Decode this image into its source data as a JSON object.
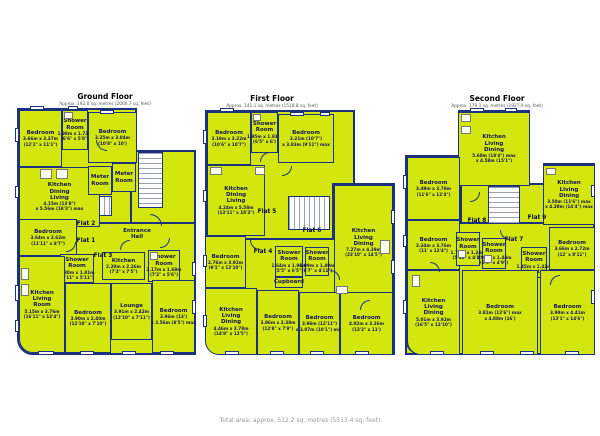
{
  "colors": {
    "room_fill": "#d3e70e",
    "wall": "#1d3181",
    "label_text": "#15135a",
    "title_text": "#000000",
    "subtitle_text": "#555555",
    "footer_text": "#9a9a9a"
  },
  "footer": {
    "total_area": "Total area: approx. 512.2 sq. metres (5513.4 sq. feet)"
  },
  "floors": [
    {
      "title": "Ground Floor",
      "subtitle": "Approx. 192.0 sq. metres (2066.7 sq. feet)",
      "title_cx": 105,
      "title_y": 92,
      "bases": [
        {
          "x": 17,
          "y": 108,
          "w": 120,
          "h": 120
        },
        {
          "x": 130,
          "y": 150,
          "w": 66,
          "h": 205
        },
        {
          "x": 17,
          "y": 222,
          "w": 179,
          "h": 133,
          "r": "0 0 0 16px"
        }
      ],
      "stairs": [
        {
          "x": 138,
          "y": 152,
          "w": 25,
          "h": 56,
          "dir": "h"
        },
        {
          "x": 88,
          "y": 196,
          "w": 24,
          "h": 20,
          "dir": "v"
        }
      ],
      "rooms": [
        {
          "name": "Bedroom",
          "dims": [
            "3.66m x 3.37m",
            "(12'1\" x 11'1\")"
          ],
          "x": 19,
          "y": 110,
          "w": 43,
          "h": 57
        },
        {
          "name": "Shower\nRoom",
          "dims": [
            "1.98m x 1.73m",
            "(6'6\" x 5'8\")"
          ],
          "x": 62,
          "y": 110,
          "w": 26,
          "h": 40
        },
        {
          "name": "Bedroom",
          "dims": [
            "3.25m x 3.04m",
            "(10'8\" x 10')"
          ],
          "x": 88,
          "y": 112,
          "w": 49,
          "h": 51
        },
        {
          "name": "Kitchen\nDining\nLiving",
          "dims": [
            "4.15m (13'8\")",
            "x 5.56m (18'3\") max"
          ],
          "x": 19,
          "y": 167,
          "w": 81,
          "h": 60
        },
        {
          "name": "Meter\nRoom",
          "dims": [],
          "x": 88,
          "y": 166,
          "w": 24,
          "h": 29
        },
        {
          "name": "Meter\nRoom",
          "dims": [],
          "x": 112,
          "y": 163,
          "w": 24,
          "h": 29
        },
        {
          "name": "Bedroom",
          "dims": [
            "3.64m x 2.62m",
            "(11'11\" x 8'7\")"
          ],
          "x": 19,
          "y": 219,
          "w": 58,
          "h": 37
        },
        {
          "name": "Entrance\nHall",
          "dims": [],
          "x": 112,
          "y": 216,
          "w": 50,
          "h": 36,
          "noborder": true
        },
        {
          "name": "Shower\nRoom",
          "dims": [
            "1.80m x 1.81m",
            "(5'11\" x 5'11\")"
          ],
          "x": 60,
          "y": 254,
          "w": 34,
          "h": 29
        },
        {
          "name": "Kitchen",
          "dims": [
            "2.20m x 2.26m",
            "(7'3\" x 7'5\")"
          ],
          "x": 102,
          "y": 252,
          "w": 43,
          "h": 28
        },
        {
          "name": "Shower\nRoom",
          "dims": [
            "2.17m x 1.68m",
            "(7'2\" x 5'6\")"
          ],
          "x": 148,
          "y": 250,
          "w": 32,
          "h": 32
        },
        {
          "name": "Kitchen\nLiving\nRoom",
          "dims": [
            "5.15m x 3.76m",
            "(16'11\" x 12'4\")"
          ],
          "x": 19,
          "y": 256,
          "w": 46,
          "h": 97,
          "r": "0 0 0 14px"
        },
        {
          "name": "Bedroom",
          "dims": [
            "3.90m x 2.40m",
            "(12'10\" x 7'10\")"
          ],
          "x": 65,
          "y": 283,
          "w": 46,
          "h": 70
        },
        {
          "name": "Lounge",
          "dims": [
            "3.91m x 2.42m",
            "(12'10\" x 7'11\")"
          ],
          "x": 111,
          "y": 283,
          "w": 41,
          "h": 57
        },
        {
          "name": "Bedroom",
          "dims": [
            "3.96m (13')",
            "x 2.56m (8'5\") max"
          ],
          "x": 152,
          "y": 280,
          "w": 43,
          "h": 73
        }
      ],
      "flats": [
        {
          "label": "Flat 2",
          "cx": 86,
          "cy": 224
        },
        {
          "label": "Flat 1",
          "cx": 86,
          "cy": 241
        },
        {
          "label": "Flat 3",
          "cx": 103,
          "cy": 256
        }
      ],
      "windows": [
        {
          "x": 15,
          "y": 128,
          "w": 4,
          "h": 14
        },
        {
          "x": 15,
          "y": 186,
          "w": 4,
          "h": 12
        },
        {
          "x": 15,
          "y": 285,
          "w": 4,
          "h": 16
        },
        {
          "x": 15,
          "y": 320,
          "w": 4,
          "h": 12
        },
        {
          "x": 30,
          "y": 106,
          "w": 14,
          "h": 4
        },
        {
          "x": 68,
          "y": 106,
          "w": 10,
          "h": 4
        },
        {
          "x": 100,
          "y": 110,
          "w": 14,
          "h": 4
        },
        {
          "x": 38,
          "y": 351,
          "w": 16,
          "h": 4
        },
        {
          "x": 80,
          "y": 351,
          "w": 14,
          "h": 4
        },
        {
          "x": 122,
          "y": 351,
          "w": 14,
          "h": 4
        },
        {
          "x": 160,
          "y": 351,
          "w": 14,
          "h": 4
        },
        {
          "x": 192,
          "y": 262,
          "w": 4,
          "h": 14
        },
        {
          "x": 192,
          "y": 300,
          "w": 4,
          "h": 14
        }
      ],
      "fixtures": [
        {
          "x": 40,
          "y": 169,
          "w": 12,
          "h": 10
        },
        {
          "x": 56,
          "y": 169,
          "w": 12,
          "h": 10
        },
        {
          "x": 21,
          "y": 268,
          "w": 8,
          "h": 12
        },
        {
          "x": 21,
          "y": 284,
          "w": 8,
          "h": 12
        },
        {
          "x": 64,
          "y": 112,
          "w": 9,
          "h": 7
        },
        {
          "x": 150,
          "y": 252,
          "w": 8,
          "h": 8
        }
      ],
      "doors": [
        {
          "x": 96,
          "y": 140,
          "s": 11,
          "c": "bl"
        },
        {
          "x": 150,
          "y": 214,
          "s": 12,
          "c": "tr"
        },
        {
          "x": 66,
          "y": 242,
          "s": 10,
          "c": "br"
        },
        {
          "x": 120,
          "y": 240,
          "s": 10,
          "c": "tl"
        },
        {
          "x": 160,
          "y": 238,
          "s": 10,
          "c": "br"
        }
      ]
    },
    {
      "title": "First Floor",
      "subtitle": "Approx. 141.1 sq. metres (1518.8 sq. feet)",
      "title_cx": 272,
      "title_y": 94,
      "bases": [
        {
          "x": 205,
          "y": 110,
          "w": 150,
          "h": 130
        },
        {
          "x": 332,
          "y": 183,
          "w": 63,
          "h": 172
        },
        {
          "x": 205,
          "y": 238,
          "w": 190,
          "h": 117,
          "r": "0 0 0 16px"
        }
      ],
      "stairs": [
        {
          "x": 288,
          "y": 196,
          "w": 42,
          "h": 34,
          "dir": "v"
        }
      ],
      "rooms": [
        {
          "name": "Bedroom",
          "dims": [
            "3.19m x 3.22m",
            "(10'6\" x 10'7\")"
          ],
          "x": 207,
          "y": 112,
          "w": 44,
          "h": 53
        },
        {
          "name": "Shower\nRoom",
          "dims": [
            "1.95m x 1.83m",
            "(6'5\" x 6')"
          ],
          "x": 251,
          "y": 112,
          "w": 27,
          "h": 41
        },
        {
          "name": "Bedroom",
          "dims": [
            "3.21m (10'7\")",
            "x 3.03m (9'11\") max"
          ],
          "x": 278,
          "y": 114,
          "w": 56,
          "h": 49
        },
        {
          "name": "Kitchen\nDining\nLiving",
          "dims": [
            "4.24m x 5.58m",
            "(13'11\" x 18'3\")"
          ],
          "x": 207,
          "y": 165,
          "w": 58,
          "h": 71
        },
        {
          "name": "Kitchen\nLiving\nDining",
          "dims": [
            "7.27m x 4.39m",
            "(23'10\" x 14'5\")"
          ],
          "x": 334,
          "y": 185,
          "w": 59,
          "h": 116
        },
        {
          "name": "Bedroom",
          "dims": [
            "2.76m x 3.92m",
            "(9'1\" x 12'10\")"
          ],
          "x": 205,
          "y": 236,
          "w": 41,
          "h": 52
        },
        {
          "name": "Shower\nRoom",
          "dims": [
            "1.64m x 1.96m",
            "(5'5\" x 6'5\")"
          ],
          "x": 275,
          "y": 246,
          "w": 28,
          "h": 31
        },
        {
          "name": "Shower\nRoom",
          "dims": [
            "1.99m x 1.49m",
            "(6'7\" x 4'11\")"
          ],
          "x": 305,
          "y": 247,
          "w": 24,
          "h": 29
        },
        {
          "name": "Cupboard",
          "dims": [],
          "x": 275,
          "y": 277,
          "w": 28,
          "h": 11
        },
        {
          "name": "Kitchen\nLiving\nDining",
          "dims": [
            "4.46m x 3.78m",
            "(14'8\" x 12'5\")"
          ],
          "x": 205,
          "y": 288,
          "w": 52,
          "h": 67,
          "r": "0 0 0 14px"
        },
        {
          "name": "Bedroom",
          "dims": [
            "3.86m x 2.38m",
            "(12'8\" x 7'9\")"
          ],
          "x": 257,
          "y": 290,
          "w": 42,
          "h": 65
        },
        {
          "name": "Bedroom",
          "dims": [
            "3.96m (12'11\")",
            "x 3.07m (10'1\") max"
          ],
          "x": 299,
          "y": 292,
          "w": 41,
          "h": 63
        },
        {
          "name": "Bedroom",
          "dims": [
            "4.02m x 3.36m",
            "(13'2\" x 11')"
          ],
          "x": 340,
          "y": 292,
          "w": 53,
          "h": 63
        }
      ],
      "flats": [
        {
          "label": "Flat 5",
          "cx": 267,
          "cy": 212
        },
        {
          "label": "Flat 6",
          "cx": 312,
          "cy": 231
        },
        {
          "label": "Flat 4",
          "cx": 263,
          "cy": 252
        }
      ],
      "windows": [
        {
          "x": 203,
          "y": 130,
          "w": 4,
          "h": 14
        },
        {
          "x": 203,
          "y": 190,
          "w": 4,
          "h": 12
        },
        {
          "x": 203,
          "y": 255,
          "w": 4,
          "h": 12
        },
        {
          "x": 203,
          "y": 315,
          "w": 4,
          "h": 12
        },
        {
          "x": 220,
          "y": 108,
          "w": 14,
          "h": 4
        },
        {
          "x": 290,
          "y": 112,
          "w": 14,
          "h": 4
        },
        {
          "x": 320,
          "y": 112,
          "w": 10,
          "h": 4
        },
        {
          "x": 225,
          "y": 351,
          "w": 14,
          "h": 4
        },
        {
          "x": 270,
          "y": 351,
          "w": 14,
          "h": 4
        },
        {
          "x": 310,
          "y": 351,
          "w": 14,
          "h": 4
        },
        {
          "x": 355,
          "y": 351,
          "w": 14,
          "h": 4
        },
        {
          "x": 391,
          "y": 210,
          "w": 4,
          "h": 14
        },
        {
          "x": 391,
          "y": 260,
          "w": 4,
          "h": 14
        }
      ],
      "fixtures": [
        {
          "x": 255,
          "y": 167,
          "w": 10,
          "h": 8
        },
        {
          "x": 210,
          "y": 167,
          "w": 12,
          "h": 8
        },
        {
          "x": 380,
          "y": 240,
          "w": 10,
          "h": 14
        },
        {
          "x": 253,
          "y": 114,
          "w": 8,
          "h": 7
        },
        {
          "x": 336,
          "y": 286,
          "w": 12,
          "h": 8
        }
      ],
      "doors": [
        {
          "x": 260,
          "y": 152,
          "s": 10,
          "c": "tl"
        },
        {
          "x": 282,
          "y": 166,
          "s": 10,
          "c": "br"
        },
        {
          "x": 250,
          "y": 240,
          "s": 10,
          "c": "bl"
        },
        {
          "x": 330,
          "y": 270,
          "s": 10,
          "c": "tr"
        },
        {
          "x": 360,
          "y": 300,
          "s": 10,
          "c": "tl"
        }
      ]
    },
    {
      "title": "Second Floor",
      "subtitle": "Approx. 179.1 sq. metres (1927.9 sq. feet)",
      "title_cx": 497,
      "title_y": 94,
      "bases": [
        {
          "x": 458,
          "y": 110,
          "w": 72,
          "h": 78
        },
        {
          "x": 405,
          "y": 155,
          "w": 57,
          "h": 200
        },
        {
          "x": 543,
          "y": 163,
          "w": 52,
          "h": 62
        },
        {
          "x": 460,
          "y": 183,
          "w": 135,
          "h": 45
        },
        {
          "x": 405,
          "y": 222,
          "w": 190,
          "h": 133,
          "r": "0 0 0 16px"
        }
      ],
      "stairs": [
        {
          "x": 488,
          "y": 186,
          "w": 32,
          "h": 38,
          "dir": "h"
        }
      ],
      "rooms": [
        {
          "name": "Kitchen\nLiving\nDining",
          "dims": [
            "5.60m (18'4\") max",
            "x 4.58m (15'1\")"
          ],
          "x": 458,
          "y": 112,
          "w": 72,
          "h": 74
        },
        {
          "name": "Bedroom",
          "dims": [
            "3.49m x 3.78m",
            "(11'6\" x 12'4\")"
          ],
          "x": 407,
          "y": 157,
          "w": 53,
          "h": 63
        },
        {
          "name": "Kitchen\nLiving\nDining",
          "dims": [
            "3.50m (11'6\") max",
            "x 4.38m (14'4\") max"
          ],
          "x": 543,
          "y": 165,
          "w": 52,
          "h": 60
        },
        {
          "name": "Bedroom",
          "dims": [
            "3.34m x 3.76m",
            "(11' x 12'4\")"
          ],
          "x": 407,
          "y": 220,
          "w": 53,
          "h": 50
        },
        {
          "name": "Shower\nRoom",
          "dims": [
            "1.79m x 1.24m",
            "(5'10\" x 4'1\")"
          ],
          "x": 456,
          "y": 232,
          "w": 24,
          "h": 34
        },
        {
          "name": "Shower\nRoom",
          "dims": [
            "2.05m x 1.44m",
            "(6'9\" x 4'9\")"
          ],
          "x": 482,
          "y": 238,
          "w": 24,
          "h": 31
        },
        {
          "name": "Shower\nRoom",
          "dims": [
            "1.45m x 1.42m",
            "(4'9\" x 4'8\")"
          ],
          "x": 521,
          "y": 247,
          "w": 26,
          "h": 31
        },
        {
          "name": "Bedroom",
          "dims": [
            "3.66m x 2.72m",
            "(12' x 8'11\")"
          ],
          "x": 549,
          "y": 227,
          "w": 46,
          "h": 43
        },
        {
          "name": "Kitchen\nLiving\nDining",
          "dims": [
            "5.01m x 3.92m",
            "(16'5\" x 12'10\")"
          ],
          "x": 407,
          "y": 270,
          "w": 53,
          "h": 85,
          "r": "0 0 0 14px"
        },
        {
          "name": "Bedroom",
          "dims": [
            "3.81m (12'6\") max",
            "x 4.88m (16')"
          ],
          "x": 462,
          "y": 270,
          "w": 76,
          "h": 85
        },
        {
          "name": "Bedroom",
          "dims": [
            "3.99m x 4.41m",
            "(13'1\" x 14'6\")"
          ],
          "x": 540,
          "y": 270,
          "w": 55,
          "h": 85
        }
      ],
      "flats": [
        {
          "label": "Flat 8",
          "cx": 477,
          "cy": 221
        },
        {
          "label": "Flat 9",
          "cx": 537,
          "cy": 218
        },
        {
          "label": "Flat 7",
          "cx": 514,
          "cy": 240
        }
      ],
      "windows": [
        {
          "x": 470,
          "y": 108,
          "w": 14,
          "h": 4
        },
        {
          "x": 505,
          "y": 108,
          "w": 12,
          "h": 4
        },
        {
          "x": 403,
          "y": 175,
          "w": 4,
          "h": 14
        },
        {
          "x": 403,
          "y": 235,
          "w": 4,
          "h": 12
        },
        {
          "x": 403,
          "y": 300,
          "w": 4,
          "h": 14
        },
        {
          "x": 430,
          "y": 351,
          "w": 14,
          "h": 4
        },
        {
          "x": 480,
          "y": 351,
          "w": 14,
          "h": 4
        },
        {
          "x": 520,
          "y": 351,
          "w": 14,
          "h": 4
        },
        {
          "x": 565,
          "y": 351,
          "w": 14,
          "h": 4
        },
        {
          "x": 591,
          "y": 185,
          "w": 4,
          "h": 12
        },
        {
          "x": 591,
          "y": 290,
          "w": 4,
          "h": 14
        }
      ],
      "fixtures": [
        {
          "x": 461,
          "y": 114,
          "w": 10,
          "h": 8
        },
        {
          "x": 461,
          "y": 126,
          "w": 10,
          "h": 8
        },
        {
          "x": 546,
          "y": 168,
          "w": 10,
          "h": 7
        },
        {
          "x": 412,
          "y": 275,
          "w": 8,
          "h": 12
        },
        {
          "x": 458,
          "y": 250,
          "w": 8,
          "h": 8
        },
        {
          "x": 484,
          "y": 255,
          "w": 8,
          "h": 8
        }
      ],
      "doors": [
        {
          "x": 500,
          "y": 230,
          "s": 10,
          "c": "bl"
        },
        {
          "x": 470,
          "y": 192,
          "s": 10,
          "c": "br"
        },
        {
          "x": 550,
          "y": 275,
          "s": 10,
          "c": "tl"
        },
        {
          "x": 430,
          "y": 262,
          "s": 10,
          "c": "tr"
        }
      ]
    }
  ]
}
